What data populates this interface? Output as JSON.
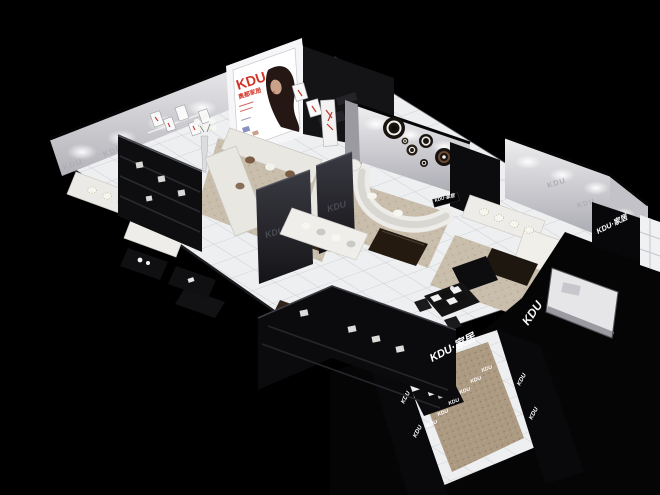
{
  "scene": {
    "description": "3D cutaway render of a KDU home-furnishing showroom floor plan on a black background",
    "background_color": "#000000"
  },
  "brand": {
    "logo": "KDU",
    "logo_full": "KDU·家居",
    "wall_watermark": "KDU",
    "poster": {
      "brand": "KDU",
      "subtitle": "奥都家居"
    }
  },
  "colors": {
    "accent_red": "#d23428",
    "wall_light": "#e8e8ea",
    "wall_shade": "#b9b9bf",
    "floor_tile": "#edeff1",
    "tile_line": "#c9ccd0",
    "carpet_beige": "#c9bdab",
    "carpet_brown": "#ad9a82",
    "sofa_white": "#edece8",
    "panel_black": "#0b0b0d",
    "panel_charcoal": "#2b2b32",
    "wood_dark": "#33261b",
    "engraved_gray": "#4a4a52",
    "sign_white": "#ffffff"
  }
}
